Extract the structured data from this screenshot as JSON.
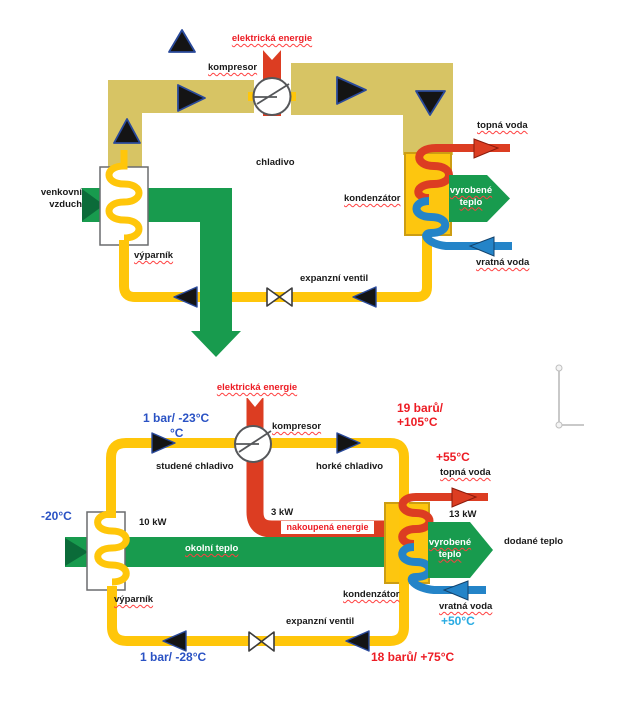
{
  "colors": {
    "khaki": "#d7c464",
    "yellow": "#ffc60a",
    "red": "#dc3d22",
    "red_text": "#ed1c24",
    "blue": "#2484c8",
    "blue_text": "#2a52c4",
    "cyan_text": "#29abe2",
    "green": "#189b4e",
    "green_dark": "#0b6b39",
    "gold": "#fdc60f",
    "gold_border": "#cc9d13",
    "arrow_fill": "#141414",
    "arrow_edge": "#2a4a9b",
    "spellcheck": "#ff4040",
    "gray_artifact": "#c9c9c9",
    "box_border": "#6a6c6e",
    "compressor_stroke": "#55575a",
    "text": "#1a1a1a"
  },
  "top": {
    "electric_energy": "elektrická energie",
    "compressor": "kompresor",
    "refrigerant": "chladivo",
    "outdoor_air": "venkovní vzduch",
    "evaporator": "výparník",
    "expansion_valve": "expanzní ventil",
    "condenser": "kondenzátor",
    "heating_water": "topná voda",
    "produced_heat": "vyrobené teplo",
    "return_water": "vratná voda"
  },
  "bottom": {
    "electric_energy": "elektrická energie",
    "compressor": "kompresor",
    "suction_state": "1 bar/ -23°C",
    "suction_state2": "°C",
    "cold_refrigerant": "studené chladivo",
    "hot_refrigerant": "horké chladivo",
    "discharge_state": "19 barů/\n+105°C",
    "electric_power": "3 kW",
    "purchased_energy": "nakoupená energie",
    "outdoor_temp": "-20°C",
    "ambient_power": "10 kW",
    "ambient_heat": "okolní teplo",
    "evaporator": "výparník",
    "expansion_valve": "expanzní ventil",
    "low_state": "1 bar/ -28°C",
    "condenser_state": "18 barů/ +75°C",
    "condenser": "kondenzátor",
    "supply_temp": "+55°C",
    "heating_water": "topná voda",
    "output_power": "13 kW",
    "produced_heat": "vyrobené teplo",
    "delivered_heat": "dodané teplo",
    "return_water": "vratná voda",
    "return_temp": "+50°C"
  }
}
